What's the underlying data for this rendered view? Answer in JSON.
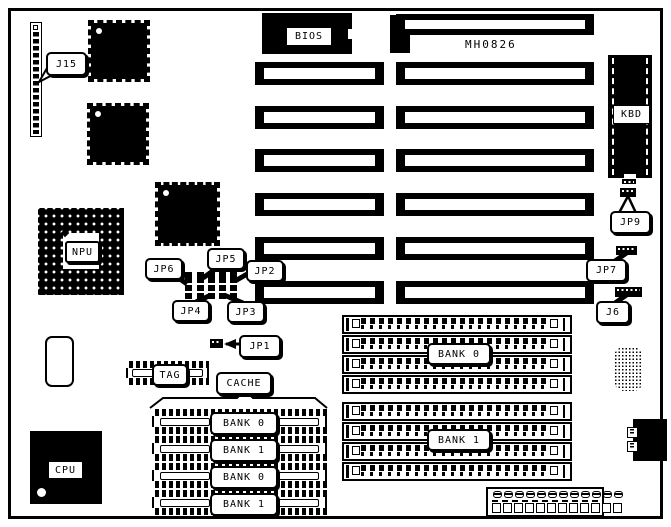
{
  "board": {
    "model_number": "MH0826",
    "ink_color": "#000000",
    "board_color": "#ffffff"
  },
  "chips": {
    "bios": "BIOS",
    "cpu": "CPU",
    "npu": "NPU"
  },
  "connectors": {
    "j15": "J15",
    "j6": "J6",
    "kbd": "KBD",
    "power_pin_count": 12
  },
  "jumpers": {
    "jp1": "JP1",
    "jp2": "JP2",
    "jp3": "JP3",
    "jp4": "JP4",
    "jp5": "JP5",
    "jp6": "JP6",
    "jp7": "JP7",
    "jp9": "JP9"
  },
  "slots": {
    "left_column_count": 6,
    "right_column_count": 7
  },
  "cache": {
    "tag_label": "TAG",
    "cache_label": "CACHE",
    "bank_rows": [
      "BANK 0",
      "BANK 1",
      "BANK 0",
      "BANK 1"
    ]
  },
  "memory": {
    "groups": [
      {
        "label": "BANK 0",
        "socket_count": 4
      },
      {
        "label": "BANK 1",
        "socket_count": 4
      }
    ]
  }
}
